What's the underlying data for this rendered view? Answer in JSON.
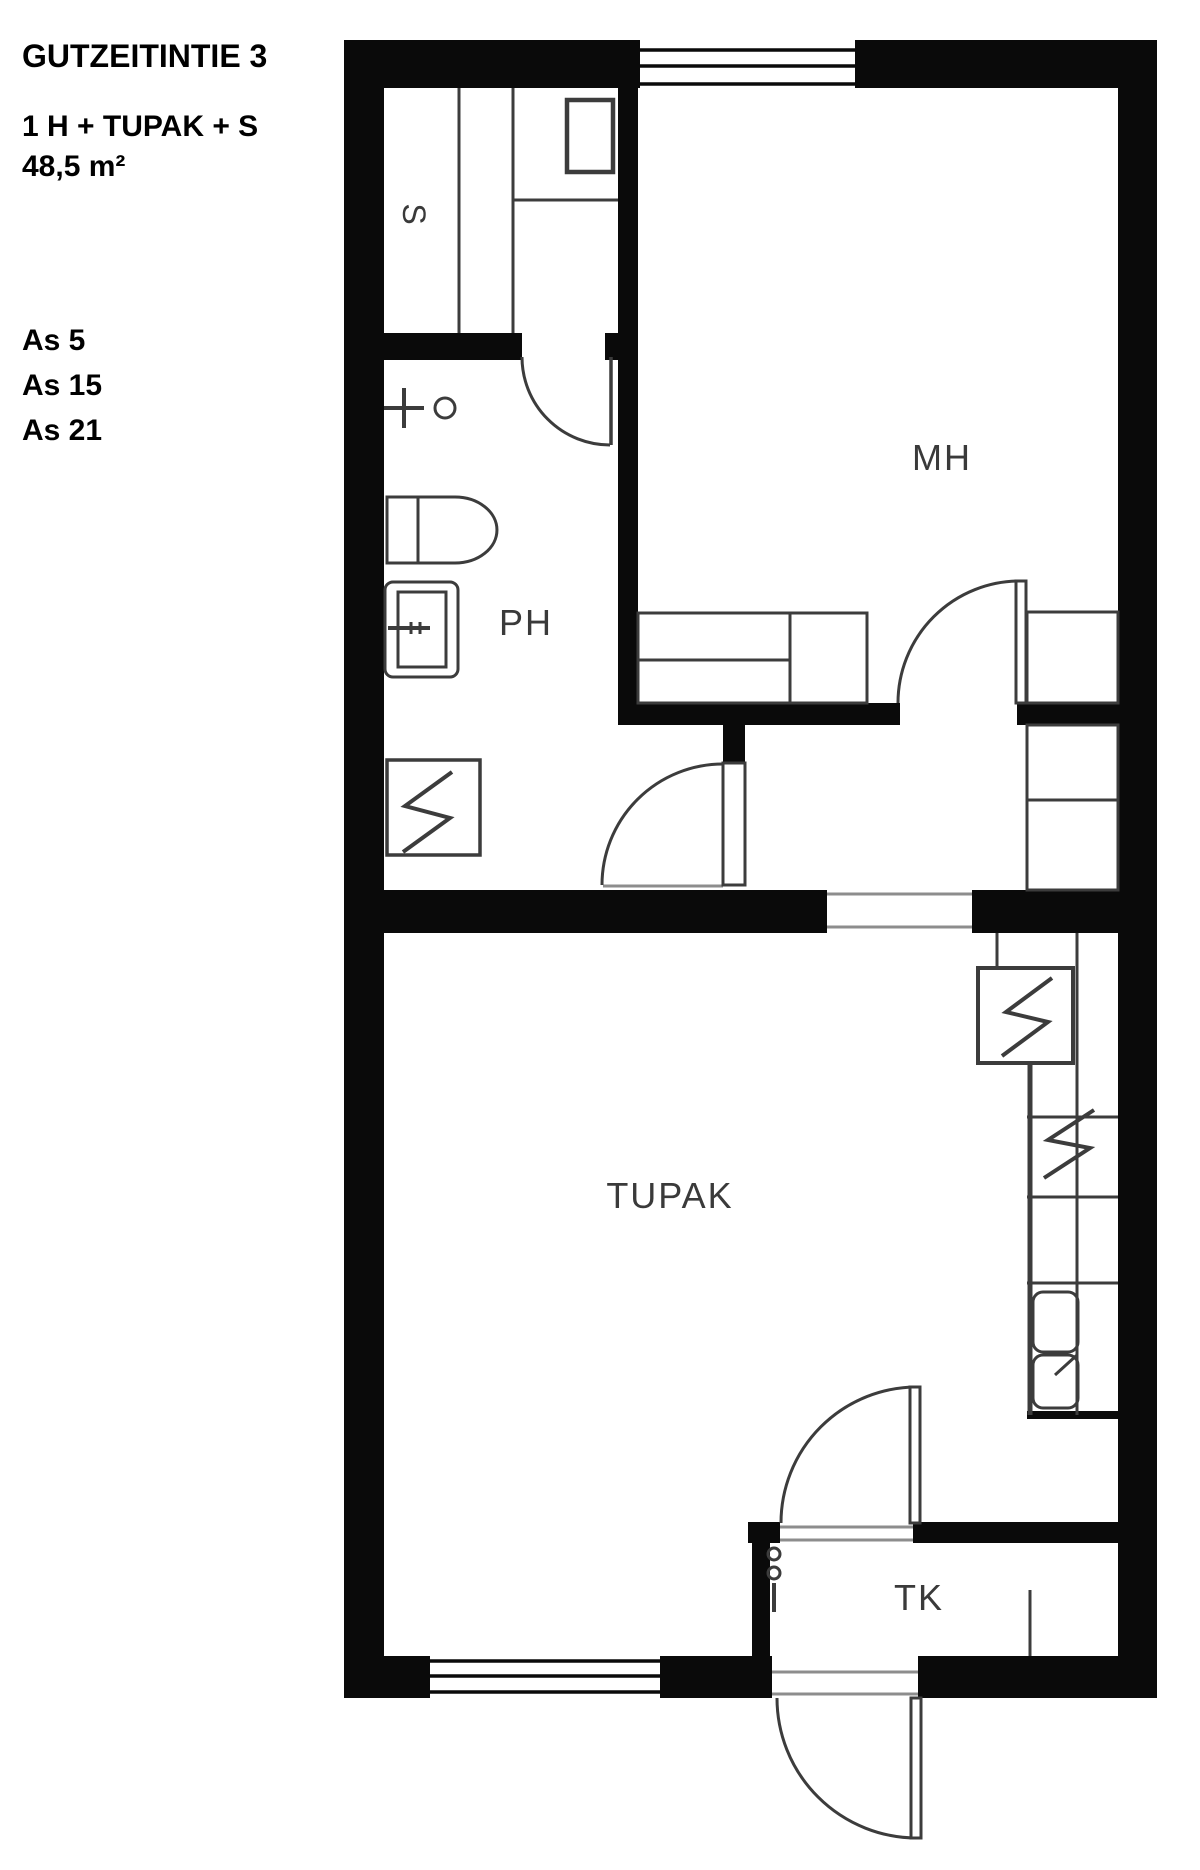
{
  "header": {
    "title": "GUTZEITINTIE 3",
    "apartment_type": "1 H + TUPAK + S",
    "area": "48,5 m²"
  },
  "apartment_numbers": [
    "As 5",
    "As 15",
    "As 21"
  ],
  "rooms": {
    "sauna": {
      "label": "S"
    },
    "bathroom": {
      "label": "PH"
    },
    "bedroom": {
      "label": "MH"
    },
    "living_kitchen": {
      "label": "TUPAK"
    },
    "vestibule": {
      "label": "TK"
    }
  },
  "colors": {
    "wall": "#0a0a0a",
    "line": "#3c3c3c",
    "threshold": "#8d8d8d",
    "label": "#3a3a3a",
    "background": "#ffffff"
  }
}
